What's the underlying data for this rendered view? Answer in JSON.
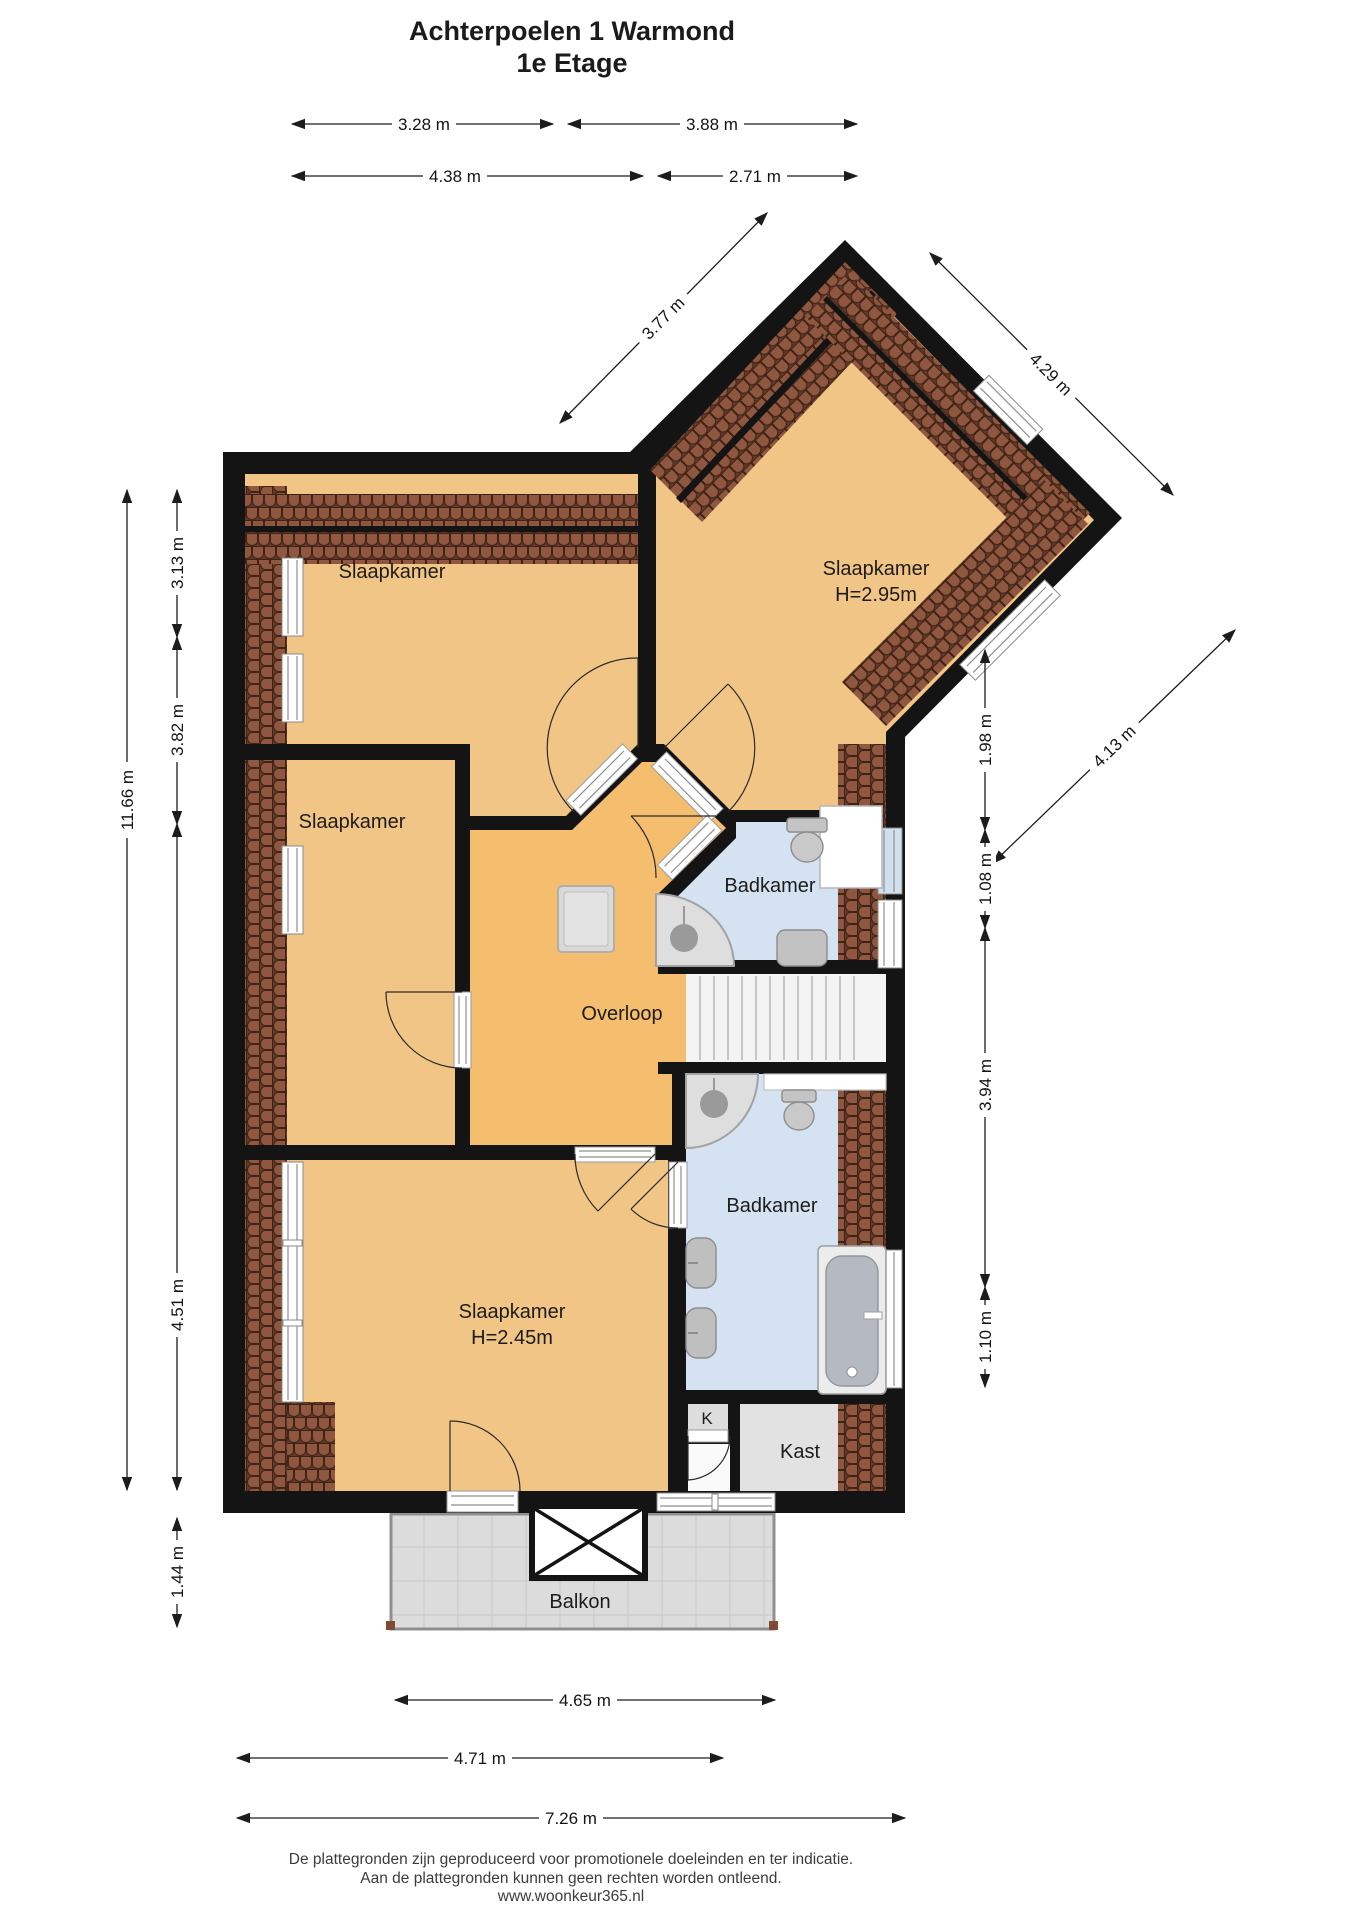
{
  "title": {
    "line1": "Achterpoelen 1  Warmond",
    "line2": "1e Etage"
  },
  "rooms": {
    "slaapkamer_topleft": "Slaapkamer",
    "slaapkamer_wing": "Slaapkamer",
    "slaapkamer_wing_height": "H=2.95m",
    "slaapkamer_middle": "Slaapkamer",
    "slaapkamer_bottom": "Slaapkamer",
    "slaapkamer_bottom_height": "H=2.45m",
    "overloop": "Overloop",
    "badkamer_top": "Badkamer",
    "badkamer_bottom": "Badkamer",
    "kast": "Kast",
    "k_closet": "K",
    "balkon": "Balkon"
  },
  "dims": {
    "top1_left": "3.28 m",
    "top1_right": "3.88 m",
    "top2_left": "4.38 m",
    "top2_right": "2.71 m",
    "diag_nw": "3.77 m",
    "diag_ne": "4.29 m",
    "diag_se": "4.13 m",
    "left_total": "11.66 m",
    "left_seg1": "3.13 m",
    "left_seg2": "3.82 m",
    "left_seg3": "4.51 m",
    "left_balcony": "1.44 m",
    "right_seg1": "1.98 m",
    "right_seg2": "1.08 m",
    "right_seg3": "3.94 m",
    "right_seg4": "1.10 m",
    "bottom1": "4.65 m",
    "bottom2": "4.71 m",
    "bottom3": "7.26 m"
  },
  "footer": {
    "line1": "De plattegronden zijn geproduceerd voor promotionele doeleinden en ter indicatie.",
    "line2": "Aan de plattegronden kunnen geen rechten worden ontleend.",
    "line3": "www.woonkeur365.nl"
  },
  "colors": {
    "wall": "#141414",
    "room_floor": "#f1c585",
    "overloop_floor": "#f5bd6e",
    "bathroom_floor": "#d4e2f2",
    "roof_tile": "#8f5740",
    "balcony_floor": "#dcdcdc"
  }
}
